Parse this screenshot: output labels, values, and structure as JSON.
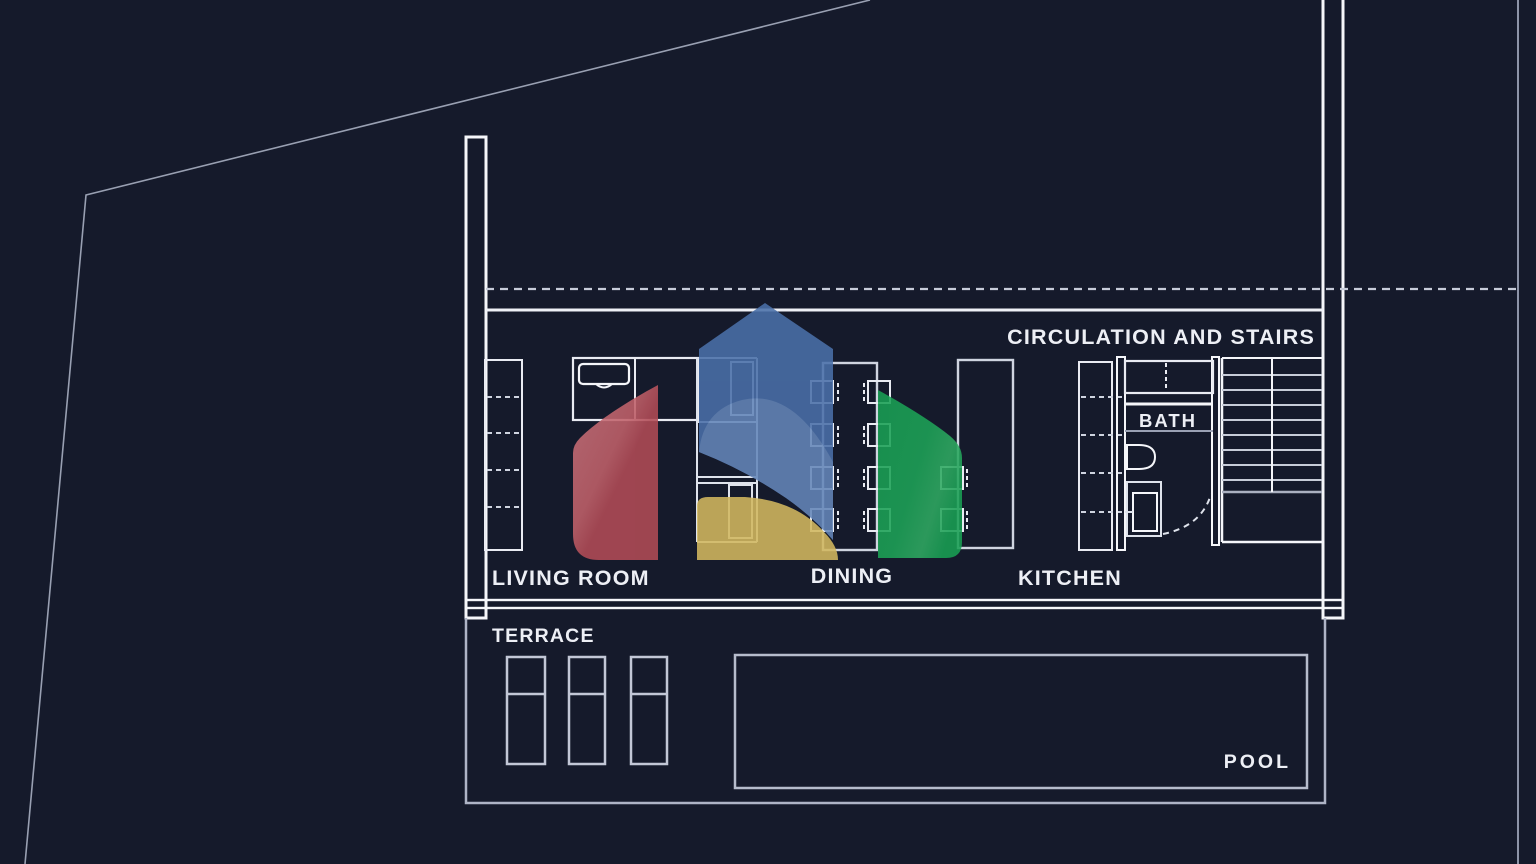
{
  "title": "Ground floor plan",
  "labels": {
    "circulation": "CIRCULATION AND STAIRS",
    "living_room": "LIVING ROOM",
    "dining": "DINING",
    "kitchen": "KITCHEN",
    "bath": "BATH",
    "terrace": "TERRACE",
    "pool": "POOL"
  },
  "rooms": [
    {
      "name": "Living room"
    },
    {
      "name": "Dining"
    },
    {
      "name": "Kitchen"
    },
    {
      "name": "Bath"
    },
    {
      "name": "Circulation and stairs"
    },
    {
      "name": "Terrace"
    },
    {
      "name": "Pool"
    }
  ],
  "colors": {
    "background": "#151a2b",
    "wall_line": "#f5f6fa",
    "furniture_line": "#e9ebf2",
    "secondary_line": "#aab1c2",
    "dashed_line": "#c7ccd9",
    "label_text": "#edeff5",
    "logo_red": "#b24b56",
    "logo_red_light": "#c76f78",
    "logo_blue": "#4a6fa9",
    "logo_blue_light": "#6486b9",
    "logo_yellow": "#d2b85f",
    "logo_green": "#189f53",
    "logo_green_light": "#35aa64"
  }
}
